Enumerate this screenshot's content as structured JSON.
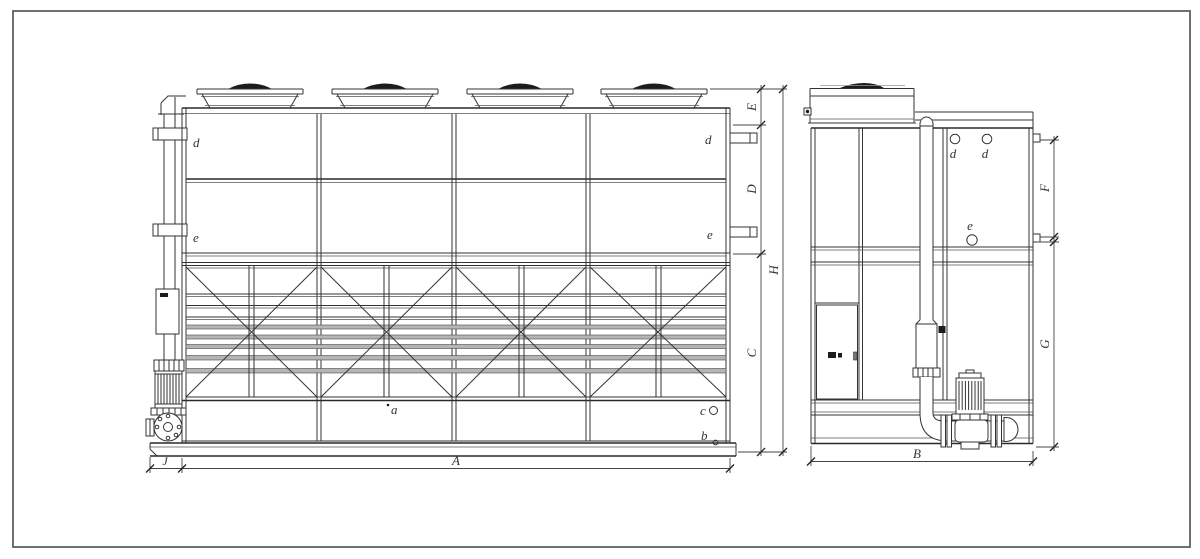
{
  "drawing": {
    "kind": "cooling-tower-general-arrangement",
    "colors": {
      "line": "#333333",
      "light_line": "#9a9a9a",
      "fan_dark": "#1c1c1c",
      "background": "#ffffff"
    }
  },
  "front": {
    "labels": {
      "d_left": "d",
      "d_right": "d",
      "e_left": "e",
      "e_right": "e",
      "a": "a",
      "b": "b",
      "c": "c"
    },
    "dims": {
      "E": "E",
      "D": "D",
      "H": "H",
      "C": "C",
      "J": "J",
      "A": "A"
    }
  },
  "side": {
    "labels": {
      "d1": "d",
      "d2": "d",
      "e": "e"
    },
    "dims": {
      "F": "F",
      "G": "G",
      "B": "B"
    }
  }
}
